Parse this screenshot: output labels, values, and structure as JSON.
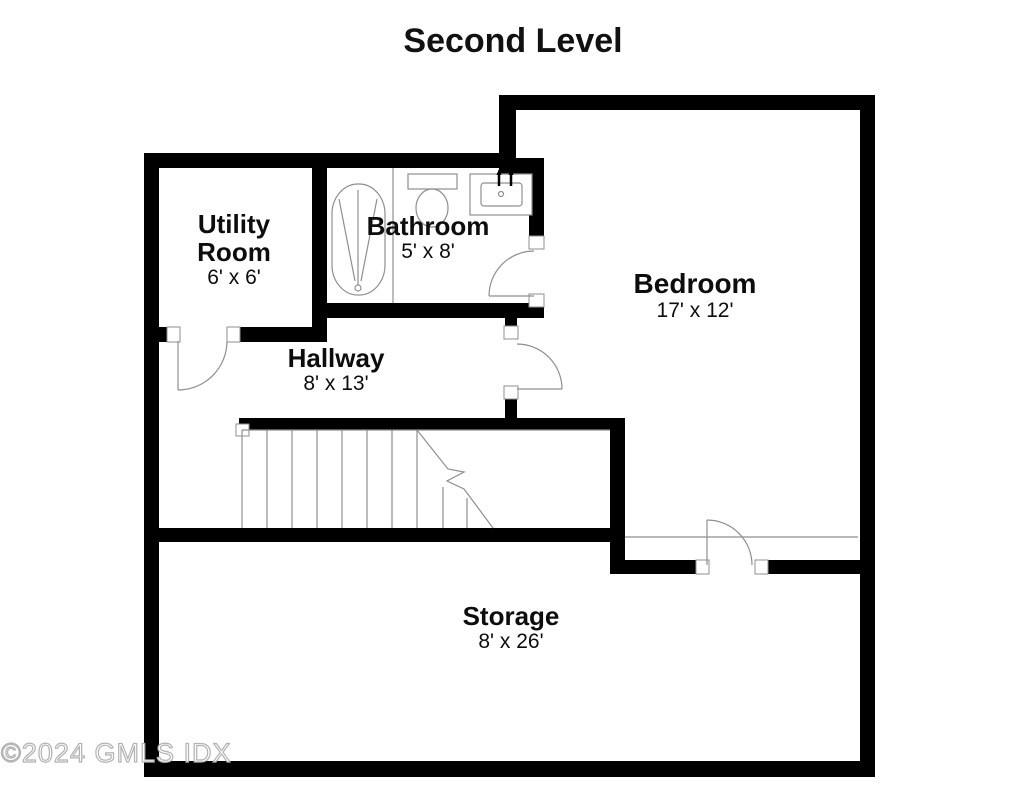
{
  "title": "Second Level",
  "watermark": "©2024 GMLS IDX",
  "rooms": [
    {
      "id": "utility-room",
      "name": "Utility Room",
      "dimensions": "6' x 6'"
    },
    {
      "id": "bathroom",
      "name": "Bathroom",
      "dimensions": "5' x 8'"
    },
    {
      "id": "bedroom",
      "name": "Bedroom",
      "dimensions": "17' x 12'"
    },
    {
      "id": "hallway",
      "name": "Hallway",
      "dimensions": "8' x 13'"
    },
    {
      "id": "storage",
      "name": "Storage",
      "dimensions": "8' x 26'"
    }
  ],
  "fixtures": [
    "bathtub",
    "toilet",
    "sink-vanity",
    "staircase",
    "door-swings"
  ],
  "colors": {
    "walls": "#000000",
    "fixture_lines": "#8f8f8f",
    "label_text": "#0d0d0d",
    "watermark": "#c8c8c8",
    "background": "#ffffff"
  }
}
